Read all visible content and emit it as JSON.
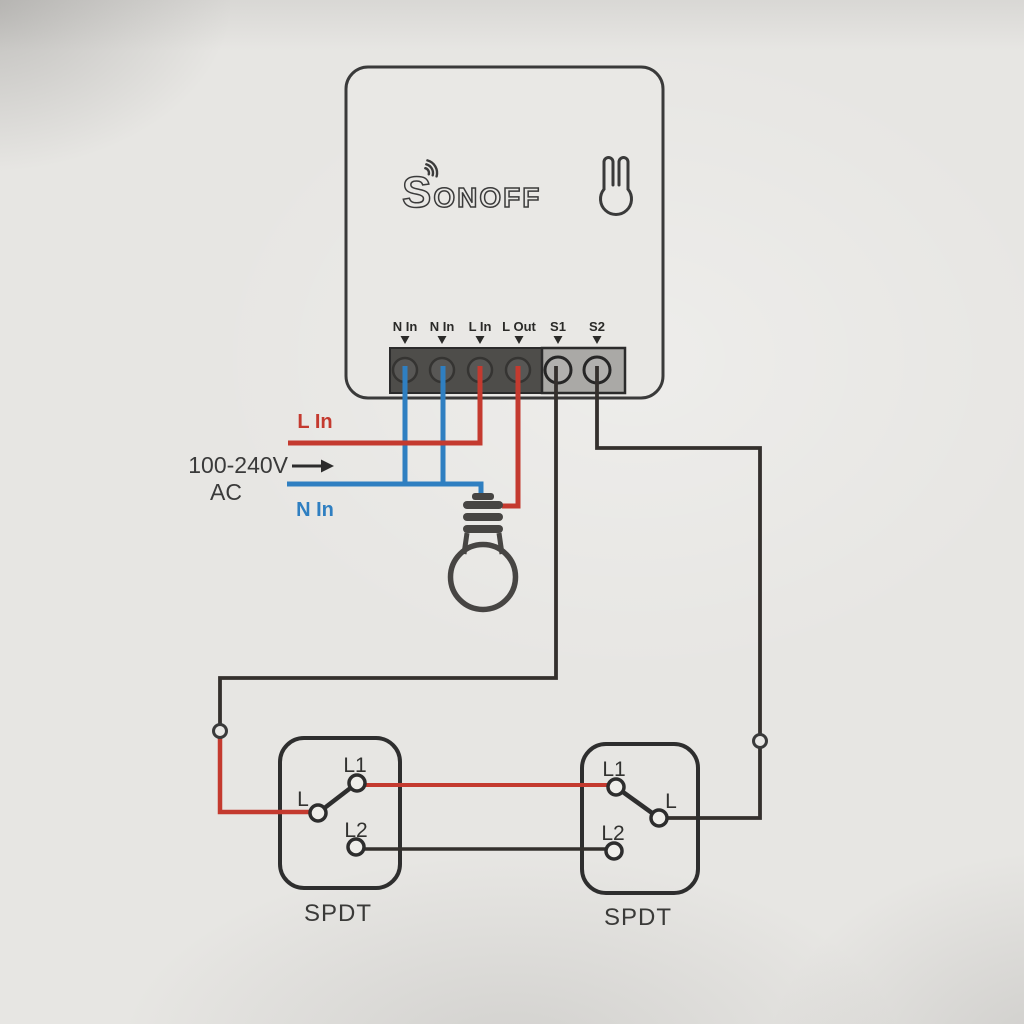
{
  "colors": {
    "paper": "#e7e6e3",
    "outline": "#3a3a3a",
    "live": "#c43a2f",
    "neutral": "#2f7fc1",
    "signal": "#34302d",
    "block_dark": "#4e4d4a",
    "block_light": "#aaa9a6",
    "text_dark": "#3a3a3a",
    "switch_text": "#323230"
  },
  "device": {
    "brand": "SONOFF",
    "brand_s": "S",
    "brand_rest": "ONOFF",
    "icons": {
      "logo_wifi": "wifi-waves",
      "mount_hole": "keyhole-hang-slot"
    },
    "terminals": [
      {
        "label": "N In"
      },
      {
        "label": "N In"
      },
      {
        "label": "L In"
      },
      {
        "label": "L Out"
      },
      {
        "label": "S1"
      },
      {
        "label": "S2"
      }
    ]
  },
  "power": {
    "live_label": "L In",
    "voltage": "100-240V",
    "ac": "AC",
    "arrow": "right-arrow",
    "neutral_label": "N In"
  },
  "load": {
    "icon": "light-bulb"
  },
  "switches": [
    {
      "label": "SPDT",
      "t1": "L1",
      "t2": "L",
      "t3": "L2"
    },
    {
      "label": "SPDT",
      "t1": "L1",
      "t2": "L",
      "t3": "L2"
    }
  ]
}
